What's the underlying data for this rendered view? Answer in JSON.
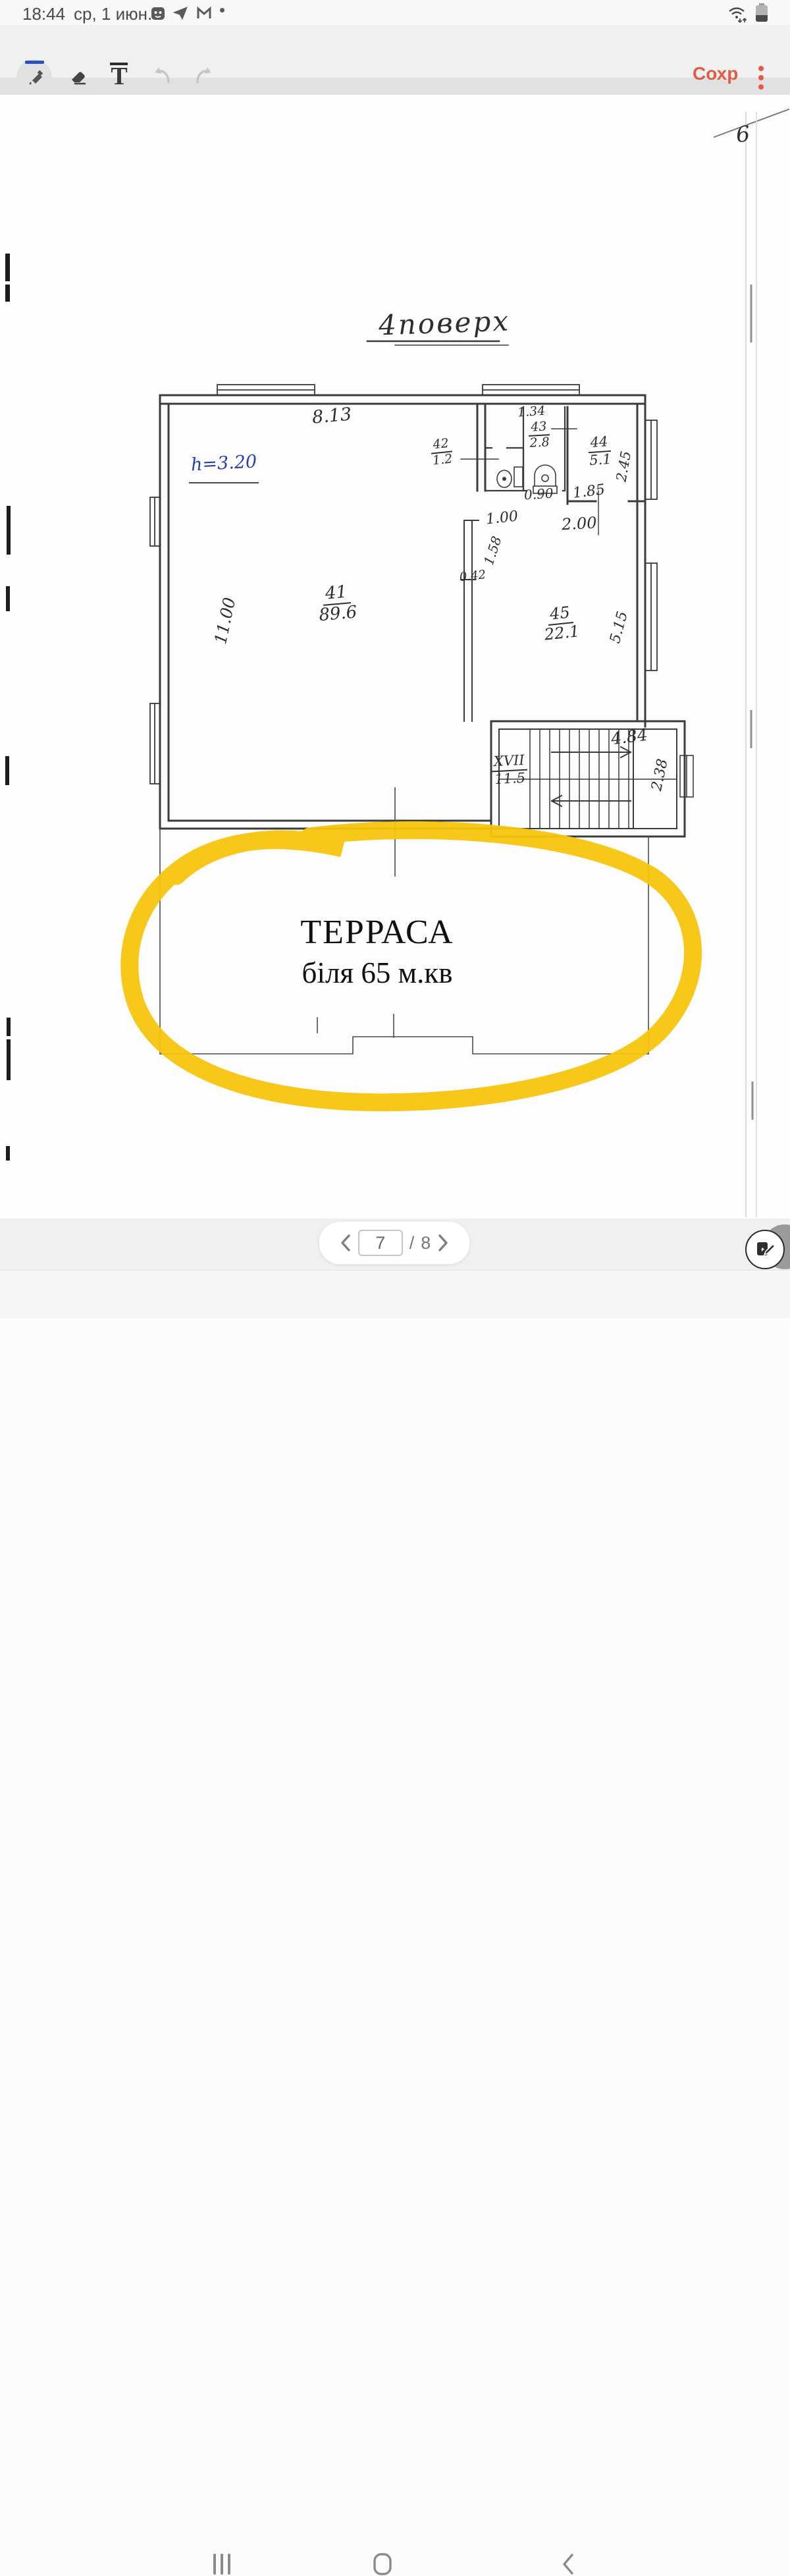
{
  "status_bar": {
    "time": "18:44",
    "date": "ср, 1 июн.",
    "icons": {
      "app1": "bot-icon",
      "app2": "telegram-icon",
      "app3": "gmail-icon",
      "more": "notification-dot",
      "wifi": "wifi-arrows-icon",
      "battery": "battery-icon"
    }
  },
  "toolbar": {
    "save_label": "Сохр",
    "accent_color": "#E25B45",
    "active_tool": "pen",
    "active_underline_color": "#2B50C6",
    "text_tool_glyph": "T",
    "tools": {
      "pen": "pen-tool",
      "eraser": "eraser-tool",
      "text": "text-tool",
      "undo": "undo-arrow",
      "redo": "redo-arrow"
    }
  },
  "document": {
    "page_number_note": "6",
    "floor_title": "4поверх",
    "height_note": "h=3.20",
    "rooms": {
      "r41": {
        "number": "41",
        "area": "89.6"
      },
      "r42": {
        "number": "42",
        "area": "1.2"
      },
      "r43": {
        "number": "43",
        "area": "2.8"
      },
      "r44": {
        "number": "44",
        "area": "5.1"
      },
      "r45": {
        "number": "45",
        "area": "22.1"
      },
      "stairs": {
        "number": "XVII",
        "area": "11.5"
      }
    },
    "dims": {
      "top_width": "8.13",
      "left_height": "11.00",
      "r43_width": "1.34",
      "r44_depth": "2.45",
      "door_43": "0.90",
      "door_44": "1.85",
      "door_41": "1.00",
      "lobby_width": "2.00",
      "hall_depth": "1.58",
      "wall_stub": "0.42",
      "r45_window": "5.15",
      "stair_width": "4.84",
      "stair_depth": "2.38"
    },
    "terrace": {
      "title": "ТЕРРАСА",
      "note": "біля 65 м.кв"
    },
    "highlight_color": "#F7C40E"
  },
  "pagination": {
    "page": "7",
    "separator": "/",
    "total": "8"
  },
  "nav_bar": {
    "recents": "recents-icon",
    "home": "home-icon",
    "back": "back-icon"
  }
}
